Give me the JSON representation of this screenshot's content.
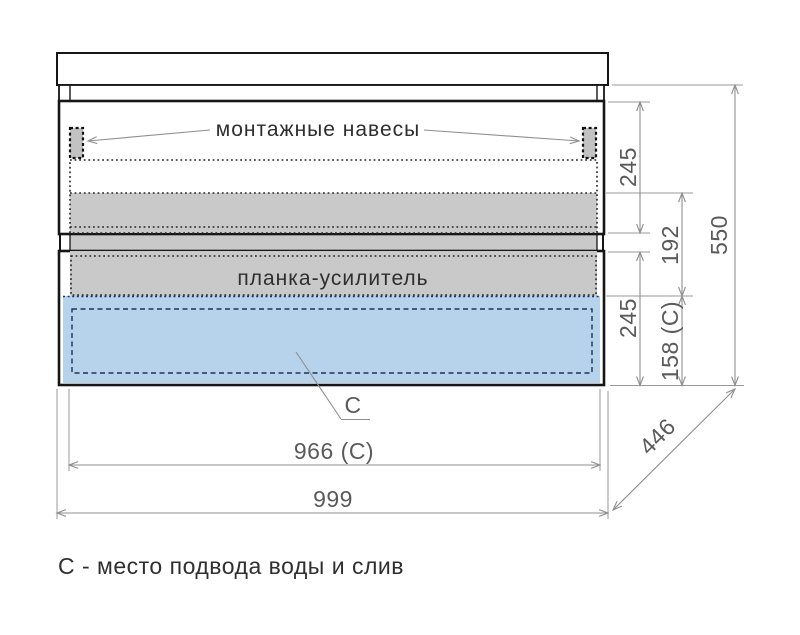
{
  "figure": {
    "type": "cabinet-installation-drawing",
    "labels": {
      "hangers": "монтажные навесы",
      "reinforcement": "планка-усилитель",
      "c_marker": "С"
    },
    "dims": {
      "top_drawer_height": "245",
      "reinforcement_span": "192",
      "bottom_drawer_height": "245",
      "c_zone_height": "158 (С)",
      "cabinet_height": "550",
      "c_zone_width": "966 (С)",
      "cabinet_width": "999",
      "cabinet_depth": "446"
    },
    "caption": "С - место подвода воды и слив",
    "colors": {
      "outline": "#161616",
      "dim_line": "#8f8f8f",
      "dim_text": "#5a5a5a",
      "label_text": "#2e2e2e",
      "gray_fill": "#c9c9c9",
      "hanger_fill": "#c2c2c2",
      "blue_fill": "#b7d2eb",
      "navy": "#16365c",
      "background": "#ffffff"
    }
  }
}
